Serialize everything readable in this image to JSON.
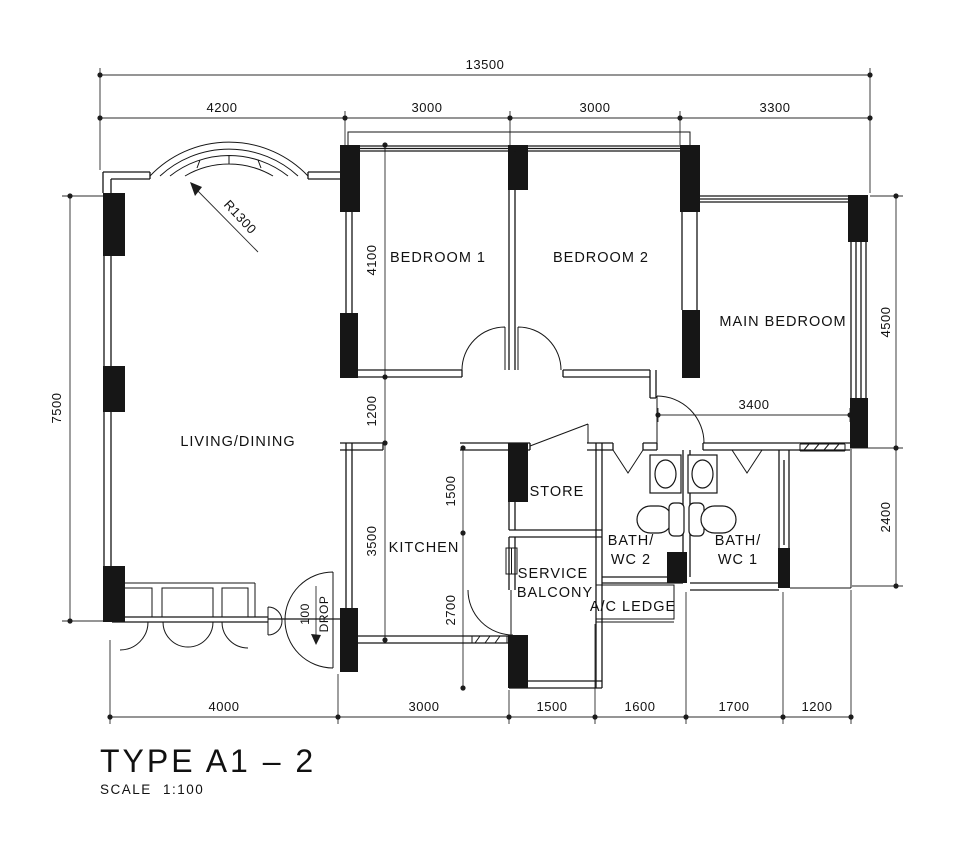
{
  "drawing": {
    "title": "TYPE A1 – 2",
    "scale_label": "SCALE",
    "scale_value": "1:100"
  },
  "rooms": {
    "bedroom1": "BEDROOM 1",
    "bedroom2": "BEDROOM 2",
    "main_bedroom": "MAIN BEDROOM",
    "living_dining": "LIVING/DINING",
    "kitchen": "KITCHEN",
    "store": "STORE",
    "service_line1": "SERVICE",
    "service_line2": "BALCONY",
    "bath2_line1": "BATH/",
    "bath2_line2": "WC 2",
    "bath1_line1": "BATH/",
    "bath1_line2": "WC 1",
    "ac_ledge": "A/C LEDGE"
  },
  "dimensions": {
    "overall_width": "13500",
    "top_segments": [
      "4200",
      "3000",
      "3000",
      "3300"
    ],
    "overall_left_height": "7500",
    "right_segments": [
      "4500",
      "2400"
    ],
    "bottom_segments": [
      "4000",
      "3000",
      "1500",
      "1600",
      "1700",
      "1200"
    ],
    "left_chain": [
      "4100",
      "1200",
      "3500"
    ],
    "mid_chain": [
      "1500",
      "2700"
    ],
    "main_bedroom_width": "3400",
    "arch_radius": "R1300",
    "drop_value": "100",
    "drop_label": "DROP"
  }
}
